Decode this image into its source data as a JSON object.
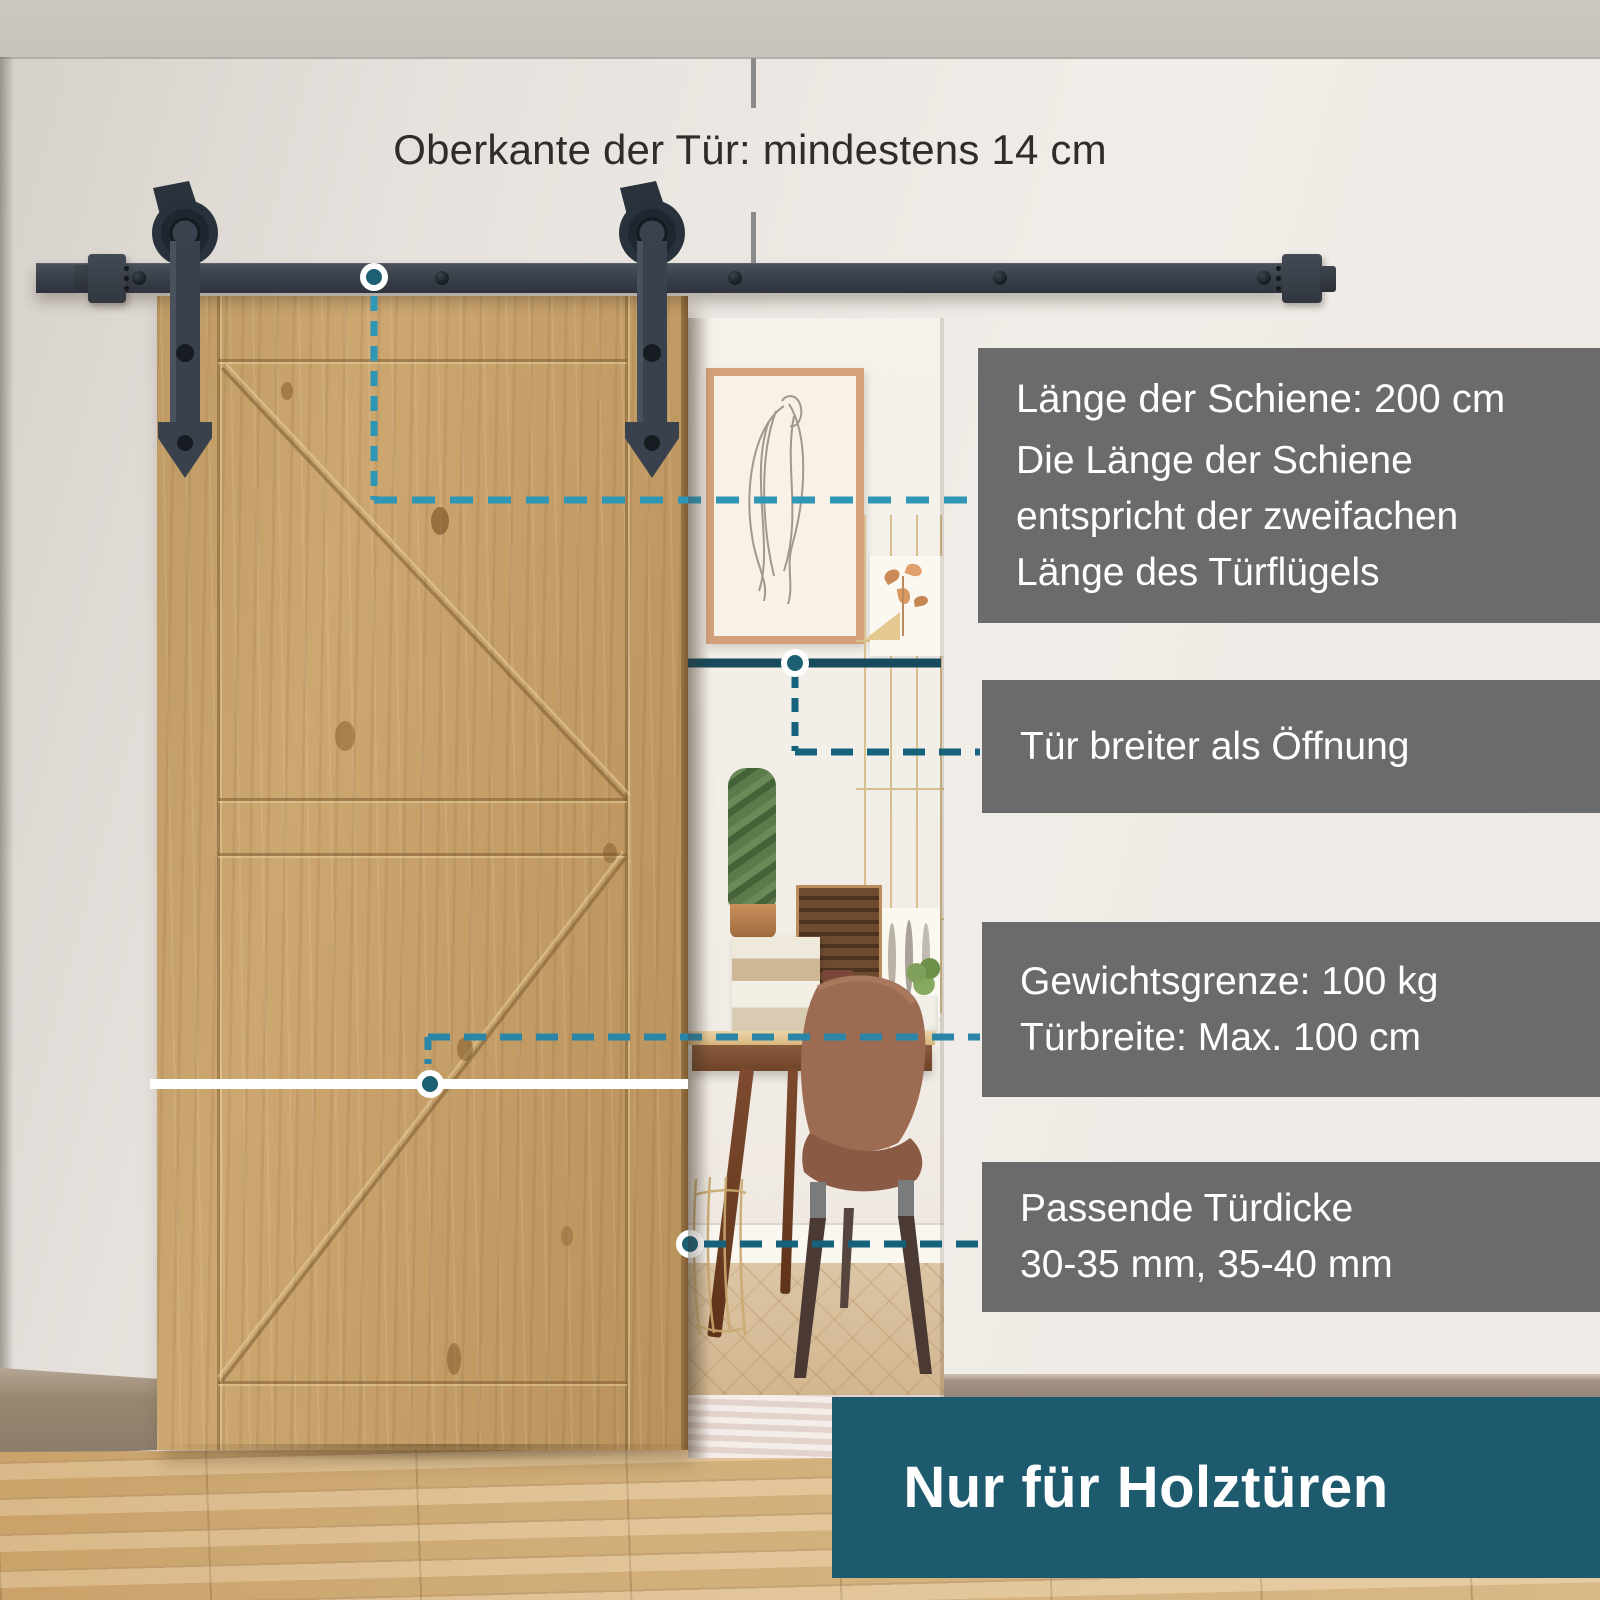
{
  "headline": {
    "text": "Oberkante der Tür: mindestens 14 cm"
  },
  "callouts": [
    {
      "id": "rail-length",
      "lines": [
        "Länge der Schiene: 200 cm",
        "Die Länge der Schiene",
        "entspricht der zweifachen",
        "Länge des Türflügels"
      ]
    },
    {
      "id": "door-wider-than-opening",
      "lines": [
        "Tür breiter als Öffnung"
      ]
    },
    {
      "id": "weight-width-limit",
      "lines": [
        "Gewichtsgrenze: 100 kg",
        "Türbreite: Max. 100 cm"
      ]
    },
    {
      "id": "door-thickness",
      "lines": [
        "Passende Türdicke",
        "30-35 mm, 35-40 mm"
      ]
    }
  ],
  "banner": {
    "text": "Nur für Holztüren"
  },
  "colors": {
    "accent_teal_dark": "#1e5a6e",
    "connector_light": "#2f96b6",
    "connector_medium": "#2a85a6",
    "connector_dark": "#16617c",
    "solid_line": "#174a5c",
    "callout_bg": "#666666",
    "hardware": "#343c46",
    "wood_door": "#c49d66",
    "floor_wood": "#dcba85"
  }
}
